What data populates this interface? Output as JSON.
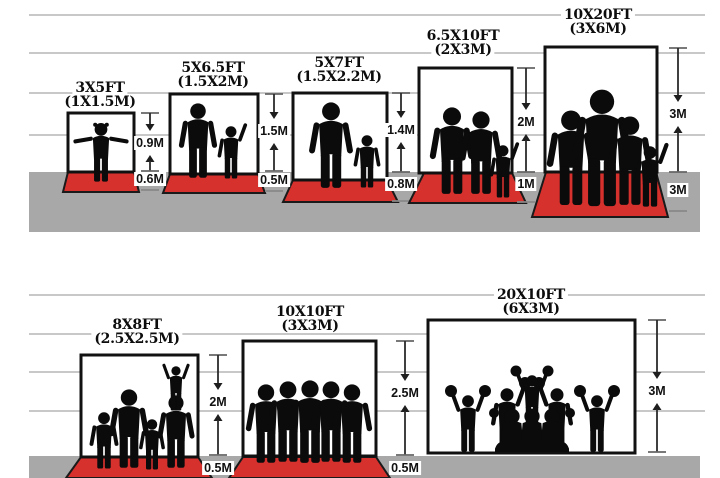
{
  "diagram_title": "Backdrop size comparison with human silhouettes",
  "colors": {
    "carpet_red": "#d7312e",
    "floor_gray": "#a8a8a8",
    "silhouette_black": "#0b0b0b",
    "gridline_gray": "#b5b5b5",
    "backdrop_white": "#ffffff",
    "outline_black": "#111111"
  },
  "rows": [
    {
      "name": "top",
      "panels": [
        {
          "size_ft": "3X5FT",
          "size_m": "(1X1.5M)",
          "height": "0.9M",
          "floor": "0.6M"
        },
        {
          "size_ft": "5X6.5FT",
          "size_m": "(1.5X2M)",
          "height": "1.5M",
          "floor": "0.5M"
        },
        {
          "size_ft": "5X7FT",
          "size_m": "(1.5X2.2M)",
          "height": "1.4M",
          "floor": "0.8M"
        },
        {
          "size_ft": "6.5X10FT",
          "size_m": "(2X3M)",
          "height": "2M",
          "floor": "1M"
        },
        {
          "size_ft": "10X20FT",
          "size_m": "(3X6M)",
          "height": "3M",
          "floor": "3M"
        }
      ]
    },
    {
      "name": "bottom",
      "panels": [
        {
          "size_ft": "8X8FT",
          "size_m": "(2.5X2.5M)",
          "height": "2M",
          "floor": "0.5M"
        },
        {
          "size_ft": "10X10FT",
          "size_m": "(3X3M)",
          "height": "2.5M",
          "floor": "0.5M"
        },
        {
          "size_ft": "20X10FT",
          "size_m": "(6X3M)",
          "height": "3M"
        }
      ]
    }
  ]
}
